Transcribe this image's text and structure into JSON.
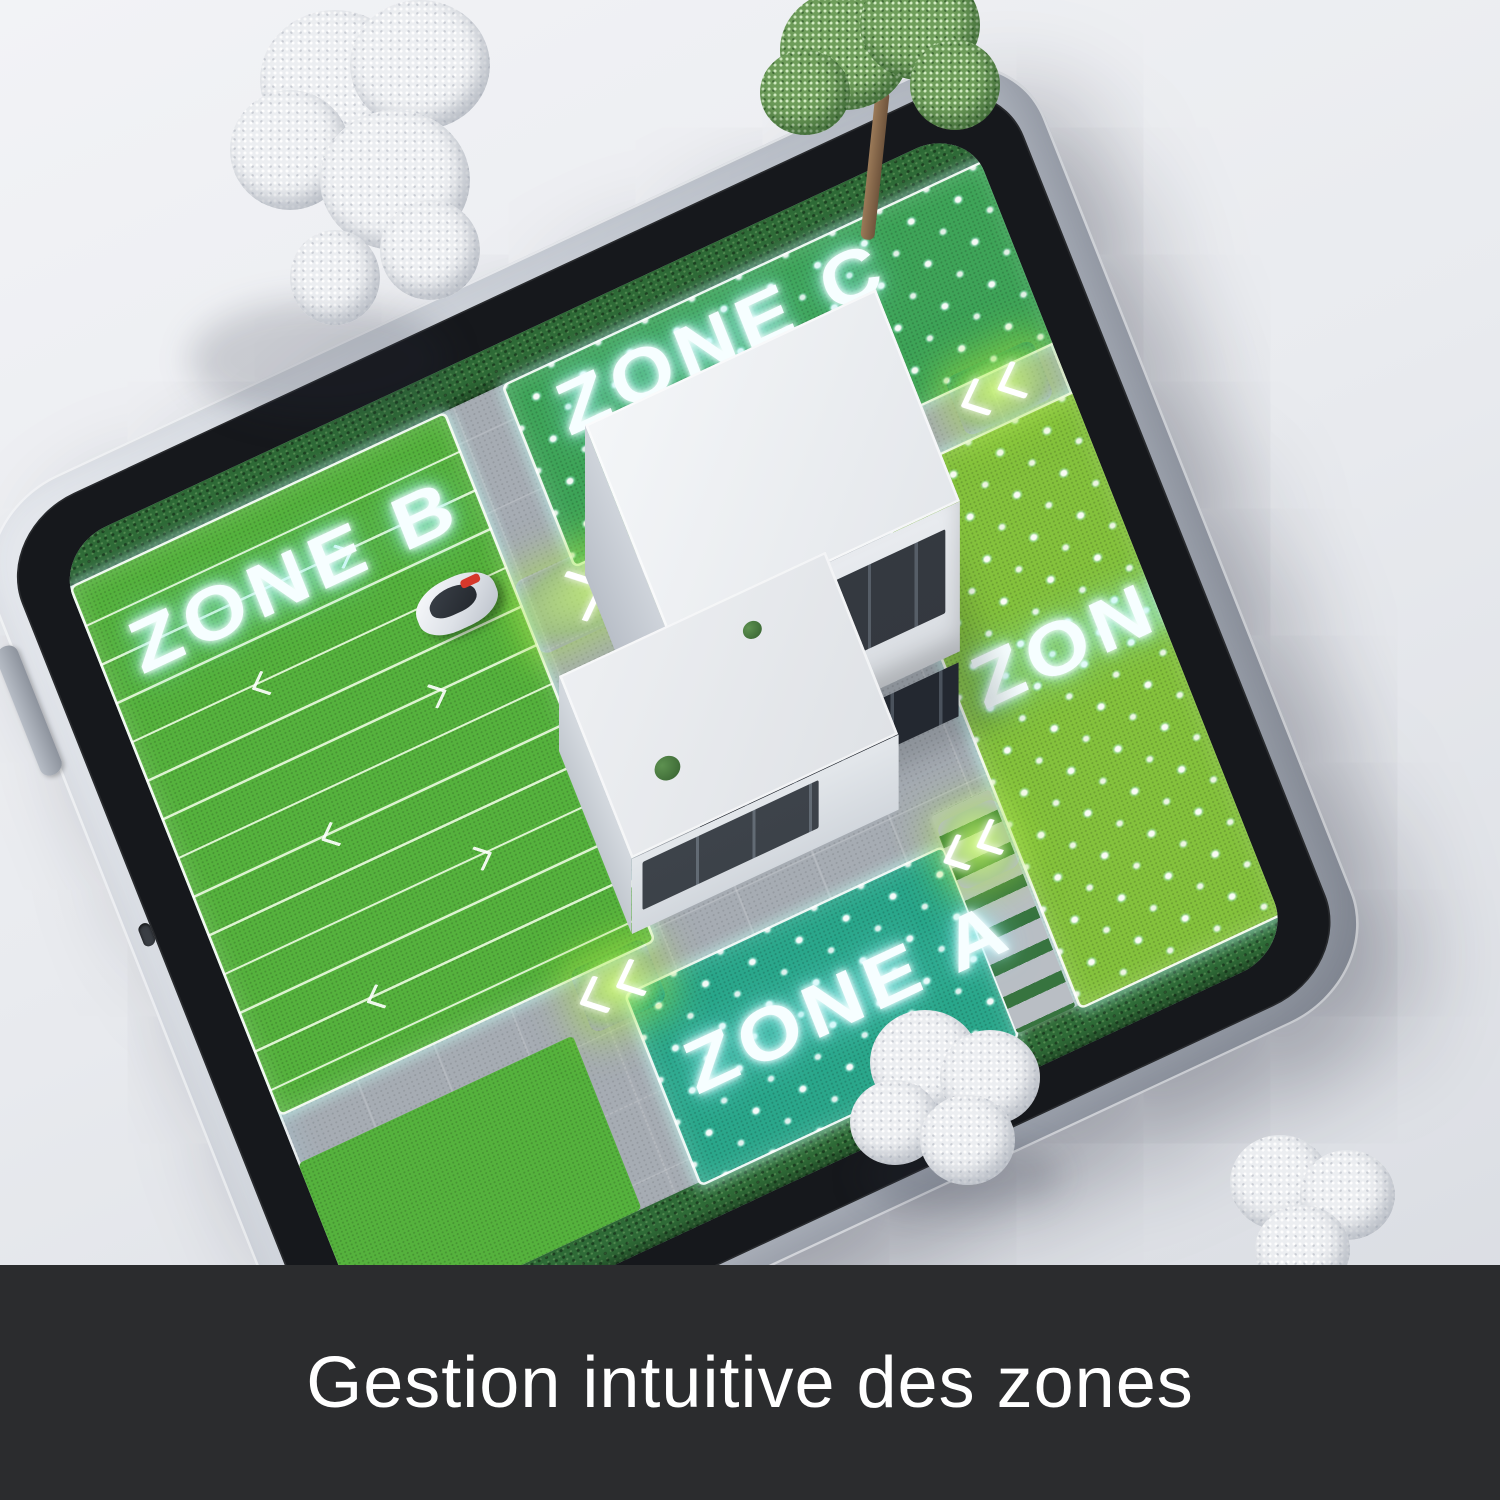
{
  "caption": {
    "text": "Gestion intuitive des zones"
  },
  "zones": {
    "b": {
      "label": "ZONE B",
      "pattern": "mowing-stripes"
    },
    "c": {
      "label": "ZONE C",
      "pattern": "dots"
    },
    "d": {
      "label": "ZONE D",
      "pattern": "dots"
    },
    "a": {
      "label": "ZONE A",
      "pattern": "dots"
    }
  },
  "device": {
    "type": "smartphone-3d-render"
  },
  "icons": [
    "chevron-path-marker-icon",
    "mow-direction-arrow-icon"
  ],
  "colors": {
    "background_top": "#f2f3f6",
    "background_bottom": "#d8dbe1",
    "caption_bg": "#2b2c2e",
    "caption_text": "#ffffff",
    "frame_silver": "#c9ced6",
    "bezel": "#16181c",
    "zone_b_green": "#55b23d",
    "zone_c_green": "#3ea458",
    "zone_d_green": "#84c23c",
    "zone_a_teal": "#2aa78b",
    "path_gray": "#a6acb3",
    "hedge_green": "#2f6b37",
    "glow_chevron": "#a8e83c",
    "label_glow": "#bdfcff",
    "house_white": "#eef0f3"
  }
}
